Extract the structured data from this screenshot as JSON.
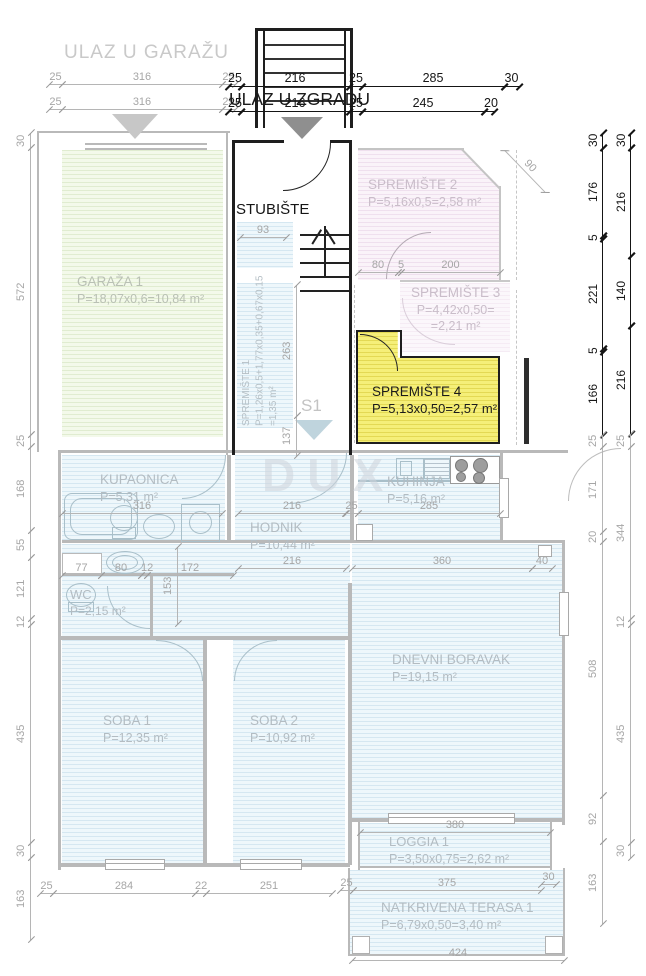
{
  "header": {
    "garage_entrance": "ULAZ U GARAŽU",
    "building_entrance": "ULAZ U ZGRADU"
  },
  "labels": {
    "staircase": "STUBIŠTE",
    "section_marker": "S1",
    "watermark": "DUX"
  },
  "rooms": {
    "garaza1": {
      "name": "GARAŽA 1",
      "area": "P=18,07x0,6=10,84 m²"
    },
    "spremiste1": {
      "name": "SPREMIŠTE 1",
      "area_line1": "P=1,26x0,5+1,77x0,35+0,67x0,15",
      "area_line2": "=1,35 m²"
    },
    "spremiste2": {
      "name": "SPREMIŠTE 2",
      "area": "P=5,16x0,5=2,58 m²"
    },
    "spremiste3": {
      "name": "SPREMIŠTE 3",
      "area_line1": "P=4,42x0,50=",
      "area_line2": "=2,21 m²"
    },
    "spremiste4": {
      "name": "SPREMIŠTE 4",
      "area": "P=5,13x0,50=2,57 m²"
    },
    "kupaonica": {
      "name": "KUPAONICA",
      "area": "P=5,31 m²"
    },
    "hodnik": {
      "name": "HODNIK",
      "area": "P=10,44 m²"
    },
    "kuhinja": {
      "name": "KUHINJA",
      "area": "P=5,16 m²"
    },
    "wc": {
      "name": "WC",
      "area": "P=2,15 m²"
    },
    "soba1": {
      "name": "SOBA 1",
      "area": "P=12,35 m²"
    },
    "soba2": {
      "name": "SOBA 2",
      "area": "P=10,92 m²"
    },
    "dnevni": {
      "name": "DNEVNI BORAVAK",
      "area": "P=19,15 m²"
    },
    "loggia": {
      "name": "LOGGIA 1",
      "area": "P=3,50x0,75=2,62 m²"
    },
    "terasa": {
      "name": "NATKRIVENA TERASA 1",
      "area": "P=6,79x0,50=3,40 m²"
    }
  },
  "colors": {
    "highlight_yellow": "#f5ef79",
    "room_blue": "#eef7fb",
    "room_green": "#f3f9ea",
    "room_pink": "#faf3f9",
    "wall_gray": "#b9b9b9",
    "wall_dark": "#1e1e1e",
    "dim_gray": "#a6a6a6",
    "dim_dark": "#161616"
  },
  "dims": {
    "garage_top_row1": [
      "25",
      "316",
      "25"
    ],
    "garage_top_row2": [
      "25",
      "316",
      "25"
    ],
    "entrance_row1": [
      "25",
      "216",
      "25",
      "285",
      "30"
    ],
    "entrance_row2": [
      "25",
      "216",
      "25",
      "245",
      "20"
    ],
    "left_margin": [
      "30",
      "572",
      "25",
      "168",
      "55",
      "121",
      "12",
      "435",
      "30",
      "163"
    ],
    "right_inner": [
      "30",
      "176",
      "5",
      "221",
      "5",
      "166",
      "25",
      "171",
      "20",
      "508",
      "92",
      "163"
    ],
    "right_outer": [
      "30",
      "216",
      "140",
      "216",
      "25",
      "344",
      "12",
      "435",
      "30"
    ],
    "stair": [
      "93",
      "263",
      "137"
    ],
    "spremiste_row": [
      "80",
      "5",
      "200"
    ],
    "diag": "90",
    "kupaonica": "316",
    "hodnik_upper": "216",
    "hodnik_lower": "216",
    "kuhinja_row": [
      "25",
      "285"
    ],
    "wc_row": [
      "77",
      "80",
      "12",
      "172"
    ],
    "wc_v": "153",
    "living_row": [
      "360",
      "40"
    ],
    "loggia": "380",
    "terasa_row": [
      "25",
      "375",
      "30"
    ],
    "terasa_bottom": "424",
    "bottom_row": [
      "25",
      "284",
      "22",
      "251"
    ]
  }
}
